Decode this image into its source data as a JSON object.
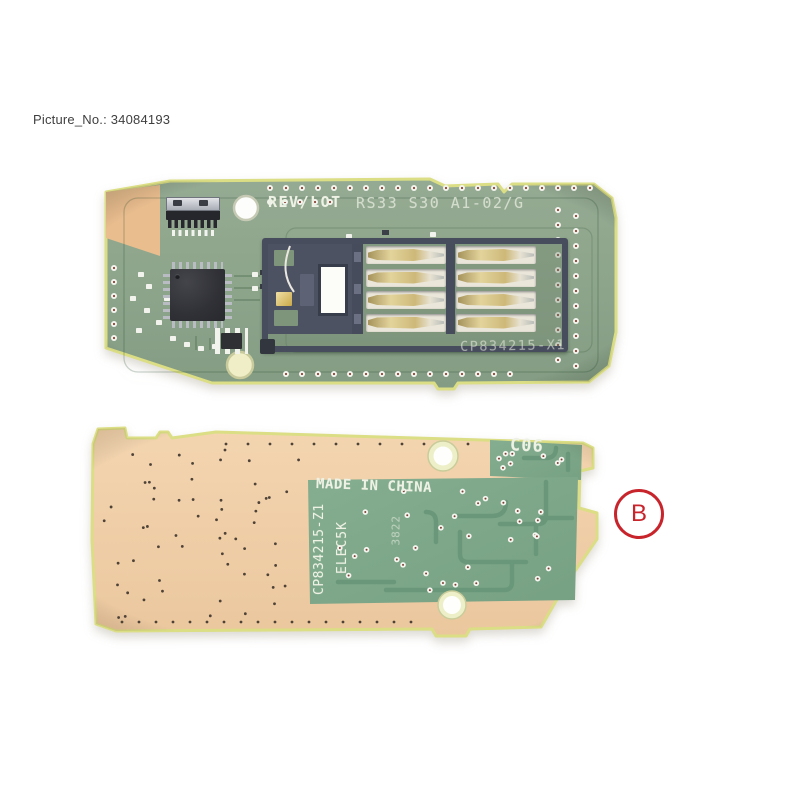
{
  "header": {
    "picture_label": "Picture_No.: 34084193"
  },
  "front_board": {
    "rev_lot_label": "REV/LOT",
    "rev_lot_value": "RS33 S30 A1-02/G",
    "part_number": "CP834215-X1"
  },
  "back_board": {
    "corner_code": "C06",
    "origin_text": "MADE IN CHINA",
    "part_number": "CP834215-Z1",
    "spec_code": "ELEC5K",
    "date_code": "3822"
  },
  "annotation": {
    "label": "B"
  },
  "colors": {
    "pcb_green": "#8da58b",
    "pcb_edge": "#dbde84",
    "copper_tan": "#f0cfa9",
    "copper_pad": "#e9bd8e",
    "patch_green": "#7fa98a",
    "silkscreen": "#eef2e4",
    "connector_dark": "#484d5e",
    "contact_gold": "#d9c88f",
    "via_center": "#8a4436",
    "annotation_red": "#c8242b",
    "label_text": "#3f3f3f"
  }
}
